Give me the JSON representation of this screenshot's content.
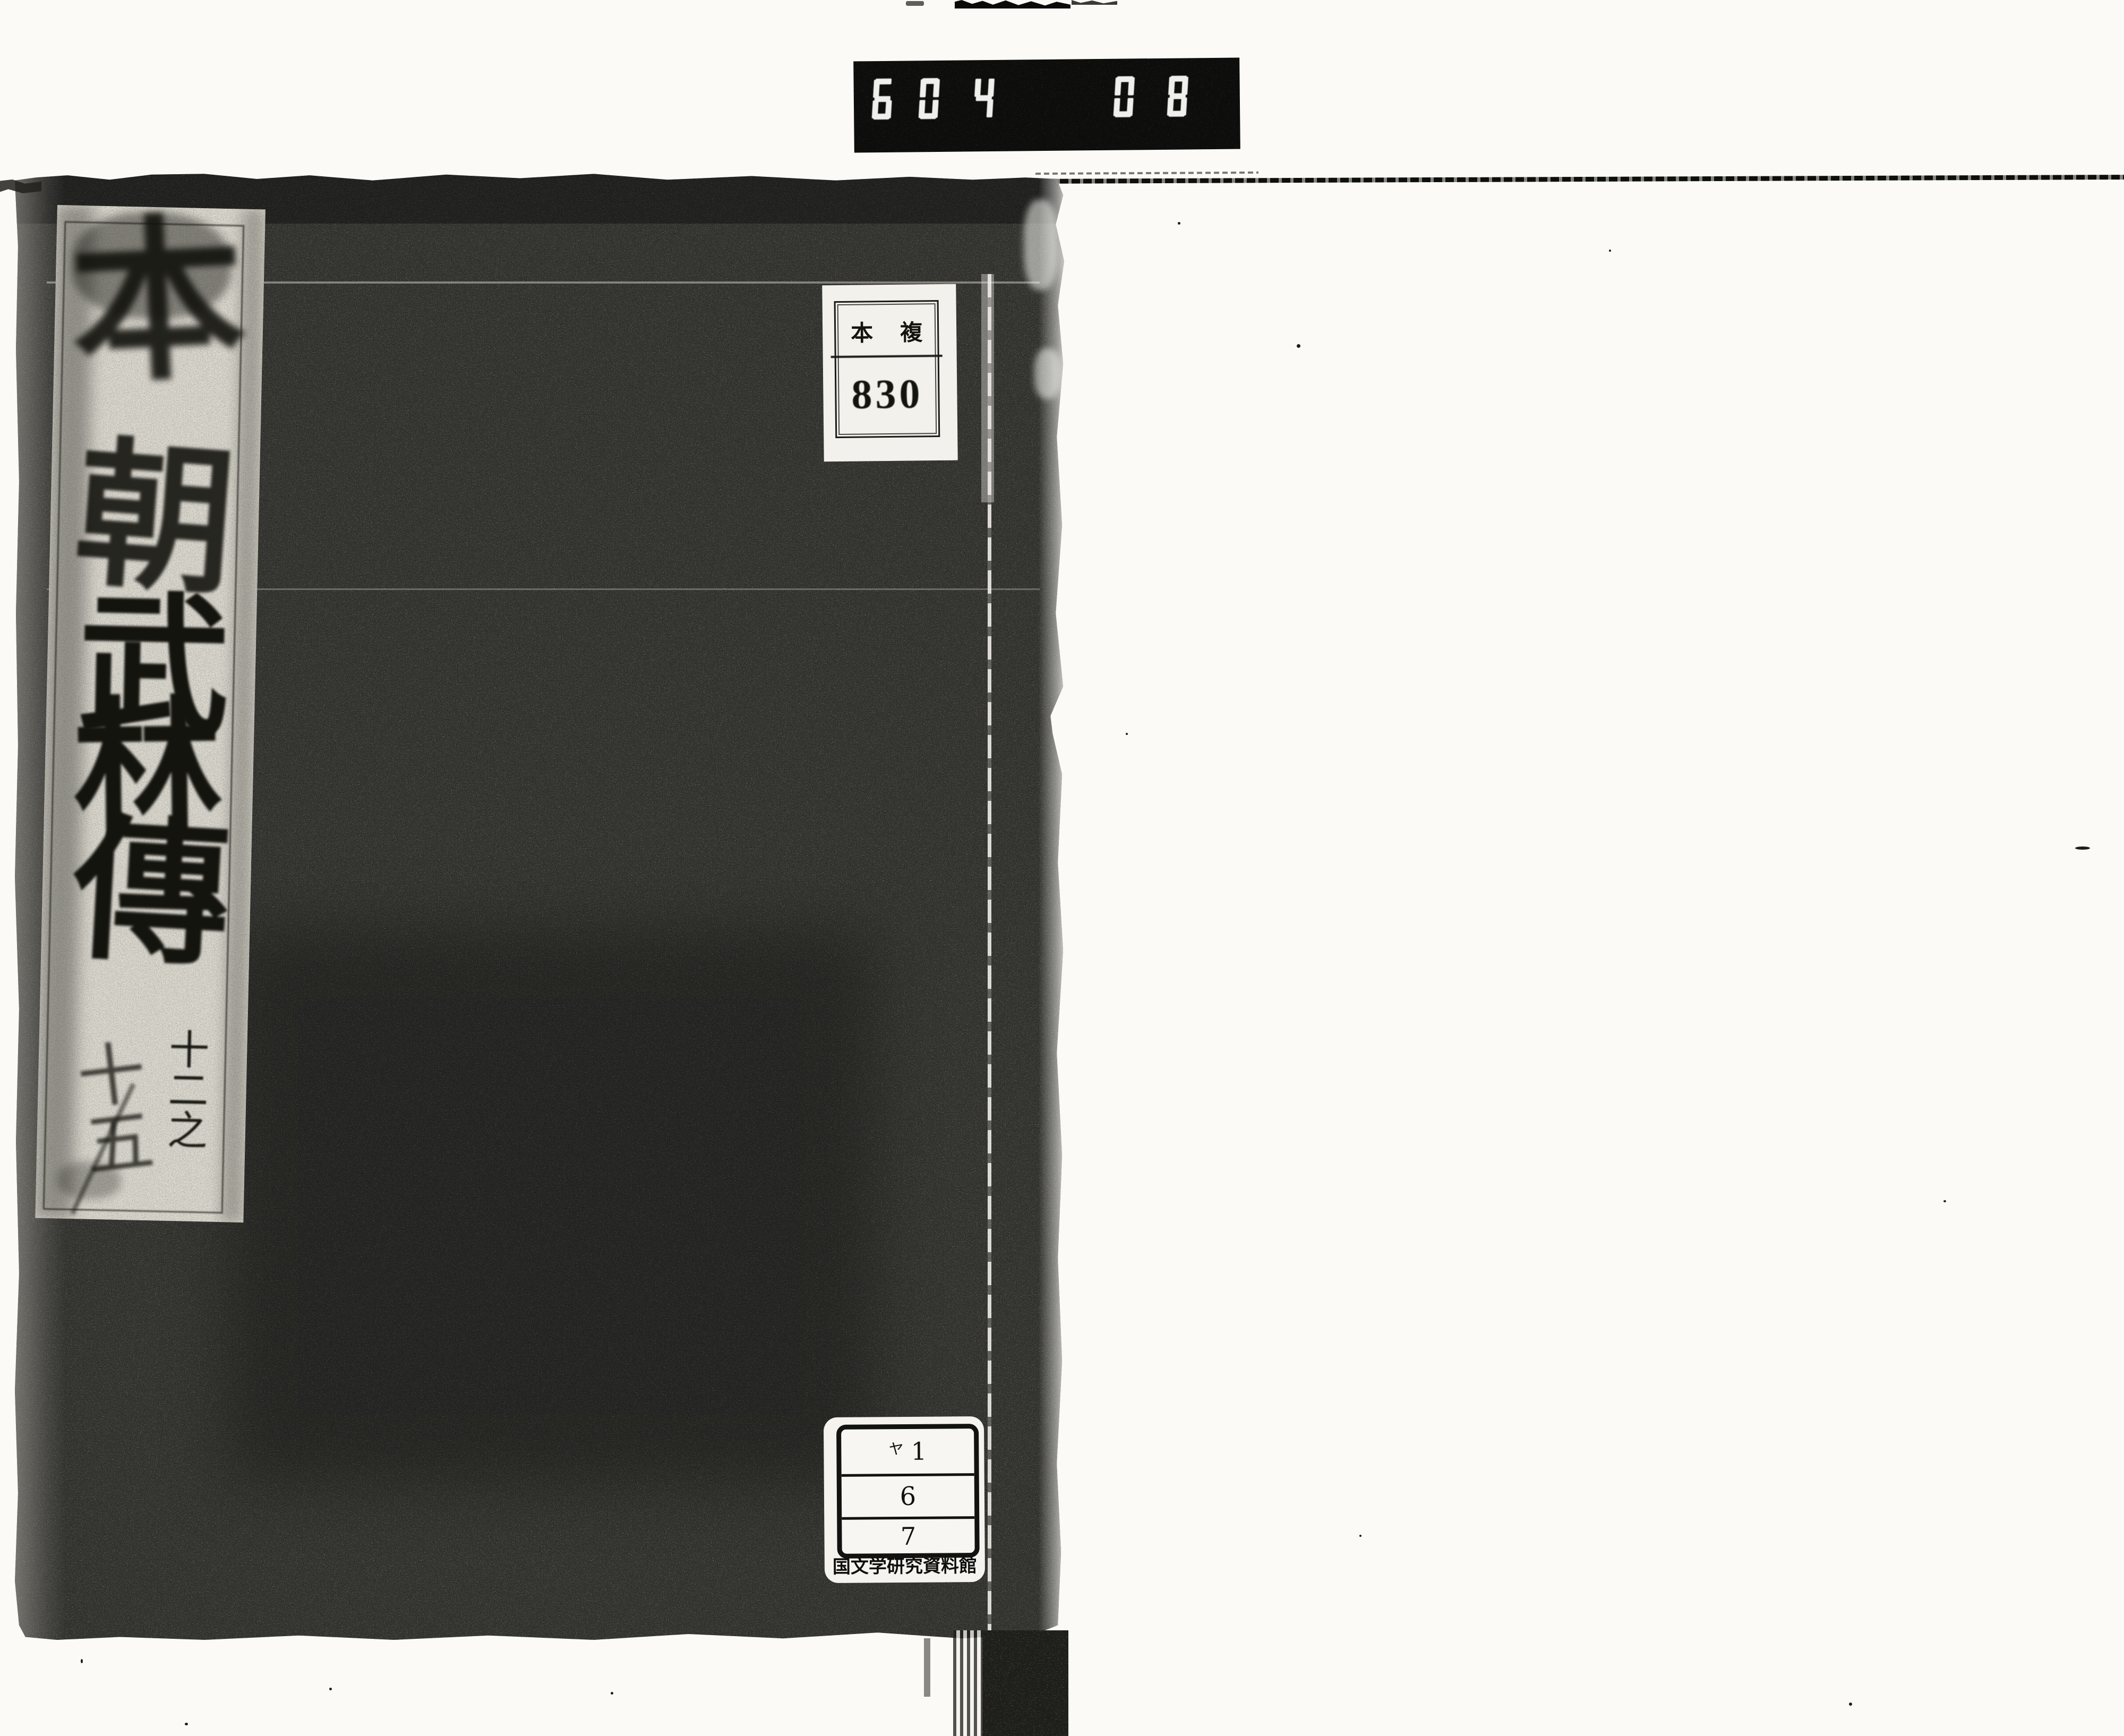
{
  "photo_counter": {
    "value": "604 081."
  },
  "shelf_label": {
    "top_left": "本",
    "top_right": "複",
    "number": "830"
  },
  "title_slip": {
    "title_chars": [
      "本",
      "朝",
      "武",
      "林",
      "傳"
    ],
    "volume_note_right": "十二之",
    "volume_note_left": "十五"
  },
  "call_number_label": {
    "rows": [
      {
        "prefix": "ヤ",
        "value": "1"
      },
      {
        "prefix": "",
        "value": "6"
      },
      {
        "prefix": "",
        "value": "7"
      }
    ],
    "institution": "国文学研究資料館"
  },
  "colors": {
    "cover": "#3a3a36",
    "slip_paper": "#dcd9d0",
    "label_paper": "#f2f1ec",
    "ink": "#14140f",
    "counter_background": "#0d0d0b",
    "counter_digits": "#efefec"
  }
}
